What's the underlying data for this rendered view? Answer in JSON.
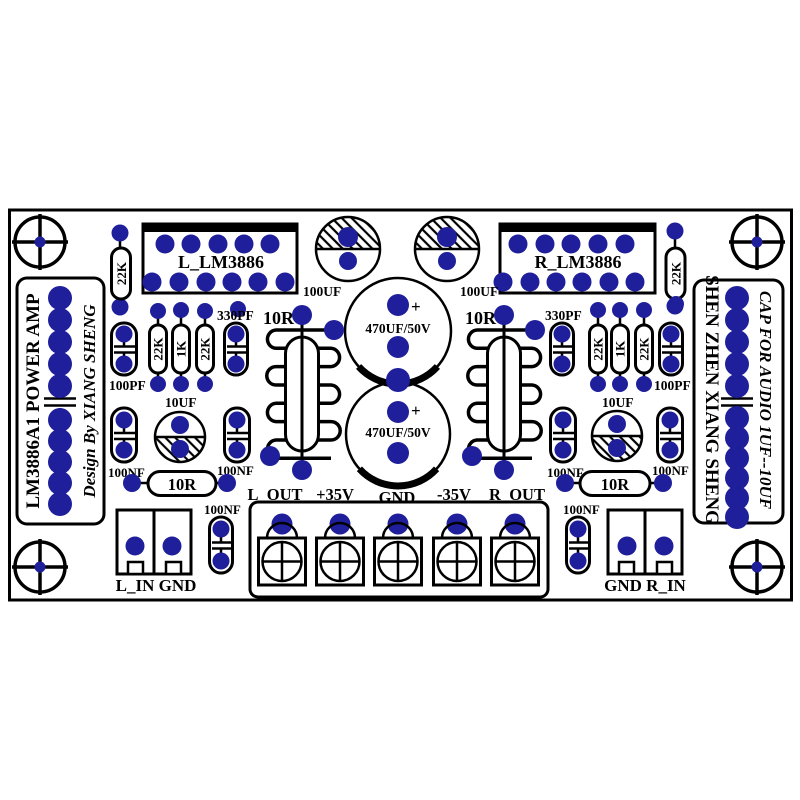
{
  "colors": {
    "pad": "#1f1f9b",
    "line": "#000000",
    "bg": "#ffffff"
  },
  "side_left": {
    "line1": "LM3886A1 POWER AMP",
    "line2": "Design By XIANG SHENG"
  },
  "side_right": {
    "line1": "SHEN ZHEN XIANG SHENG",
    "line2": "CAP FOR AUDIO 1UF--10UF"
  },
  "ics": {
    "left": "L_LM3886",
    "right": "R_LM3886"
  },
  "labels": {
    "r22k": "22K",
    "r1k": "1K",
    "r10r": "10R",
    "c100uf": "100UF",
    "c470uf": "470UF/50V",
    "plus": "+",
    "c330pf": "330PF",
    "c100pf": "100PF",
    "c100nf": "100NF",
    "c10uf": "10UF"
  },
  "terminals": [
    "L_OUT",
    "+35V",
    "GND",
    "-35V",
    "R_OUT"
  ],
  "inputs": {
    "left": "L_IN GND",
    "right": "GND R_IN"
  }
}
